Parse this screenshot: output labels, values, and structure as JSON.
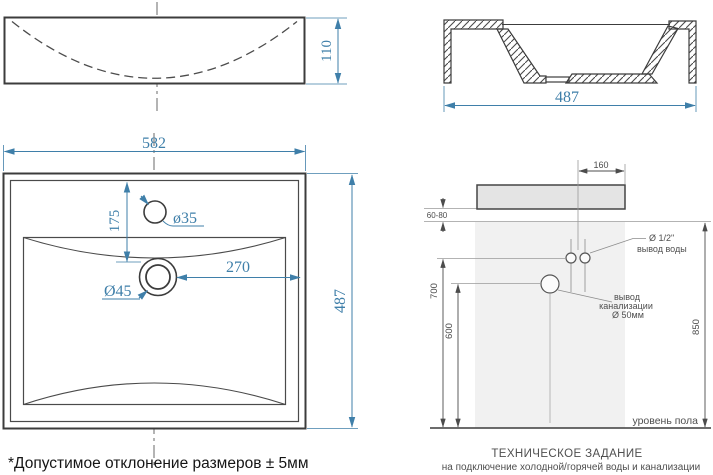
{
  "sheet": {
    "type": "technical-drawing",
    "subject": "washbasin dimensions and installation specification",
    "colors": {
      "dimension_blue": "#3f7fa9",
      "drawing_line": "#3c3c3c",
      "gray_line": "#8c8c8c",
      "gray_text": "#4c4c4c",
      "sink_fill": "#e4e4e4",
      "wall_fill": "#f1f1f1"
    },
    "front_view": {
      "height": "110"
    },
    "section_view": {
      "width": "487"
    },
    "top_view": {
      "width": "582",
      "depth": "487",
      "faucet_offset": "175",
      "faucet_hole": "ø35",
      "drain_hole": "Ø45",
      "drain_offset": "270"
    },
    "installation": {
      "tap_offset": "160",
      "wall_gap": "60-80",
      "water_height": "700",
      "drain_height": "600",
      "rim_height": "850",
      "water_outlet_size": "Ø 1/2\"",
      "water_outlet_label": "вывод воды",
      "drain_label_line1": "вывод",
      "drain_label_line2": "канализации",
      "drain_label_line3": "Ø 50мм",
      "floor_label": "уровень пола",
      "title": "ТЕХНИЧЕСКОЕ ЗАДАНИЕ",
      "subtitle": "на подключение холодной/горячей воды и канализации"
    },
    "footnote": "*Допустимое отклонение размеров ± 5мм"
  }
}
